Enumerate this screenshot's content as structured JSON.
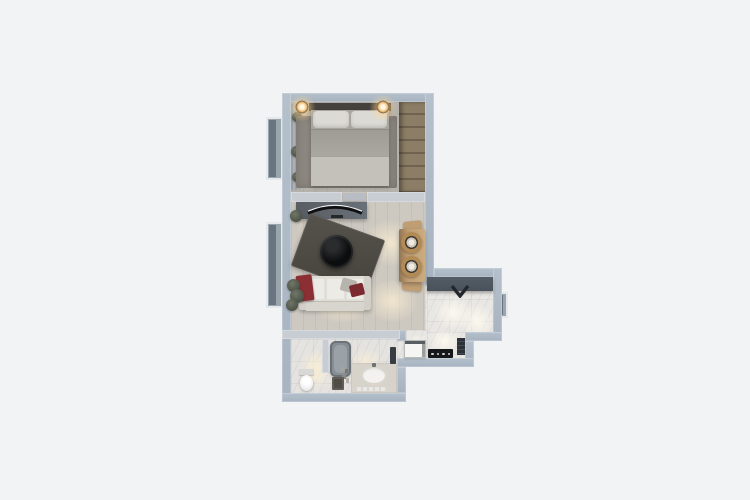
{
  "scene": {
    "type": "3d-rendered-floor-plan-top-view",
    "rooms": [
      {
        "id": "bedroom",
        "objects": [
          "double-bed",
          "headboard",
          "pillows",
          "bedside-lamp-left",
          "bedside-lamp-right",
          "area-rug",
          "wardrobe",
          "curtain",
          "plants",
          "window"
        ]
      },
      {
        "id": "living-room",
        "objects": [
          "tv-console",
          "curved-tv",
          "dark-area-rug",
          "round-coffee-table",
          "sofa",
          "red-throw",
          "throw-pillows",
          "plant",
          "window"
        ]
      },
      {
        "id": "dining-nook",
        "objects": [
          "wooden-table",
          "rattan-chair-top",
          "rattan-chair-bottom"
        ]
      },
      {
        "id": "kitchen-entry",
        "objects": [
          "dark-counter",
          "wall-faucet",
          "cooktop",
          "radiator",
          "side-window"
        ]
      },
      {
        "id": "hallway",
        "objects": [
          "washing-machine"
        ]
      },
      {
        "id": "bathroom",
        "objects": [
          "shower-tray",
          "toilet",
          "vanity-counter",
          "oval-basin",
          "bath-mat",
          "towel-rail",
          "shelf-items",
          "partition-wall"
        ]
      }
    ],
    "palette": {
      "bg": "#f2f3f4",
      "wallOuter": "#b4c0cb",
      "wallOuterD": "#a7b3c0",
      "wallInner": "#c8cdd3",
      "windowFrame": "#9aa5ae",
      "windowSlat": "#68747f",
      "floorBedroom": "#b5b1ab",
      "floorWood": "#cdc8c0",
      "marble": "#e9e7e3",
      "marbleBath": "#e5e3e0",
      "rugBedroom": "#8d8780",
      "rugLiving": "#46423c",
      "headboard": "#45413c",
      "duvet": "#a9a6a0",
      "pillow": "#dcdad5",
      "blanket": "#c4c1ba",
      "woodWardrobeA": "#8c7e66",
      "woodWardrobeB": "#6f6350",
      "console": "#585d63",
      "tvBlack": "#0f1012",
      "tableBlack": "#0c0d0e",
      "sofaBase": "#e0ddd7",
      "sofaCushion": "#edebe6",
      "accentRed": "#8c2f35",
      "accentRedDark": "#7c2a30",
      "pillowGray": "#b7b4ae",
      "woodTable": "#c09e74",
      "woodTableDark": "#8f7352",
      "rattan": "#b28a55",
      "counterDark": "#49525b",
      "stoveBlack": "#15171a",
      "appliance": "#f5f5f4",
      "radiatorDark": "#2d3238",
      "showerTray": "#878e94",
      "vanity": "#d8d3ca",
      "basin": "#f3f2f0",
      "curtain": "#9aa0a6",
      "plantGreen": "#4d5347",
      "plantLight": "#707768",
      "lampWarm": "#f0c27e"
    }
  }
}
